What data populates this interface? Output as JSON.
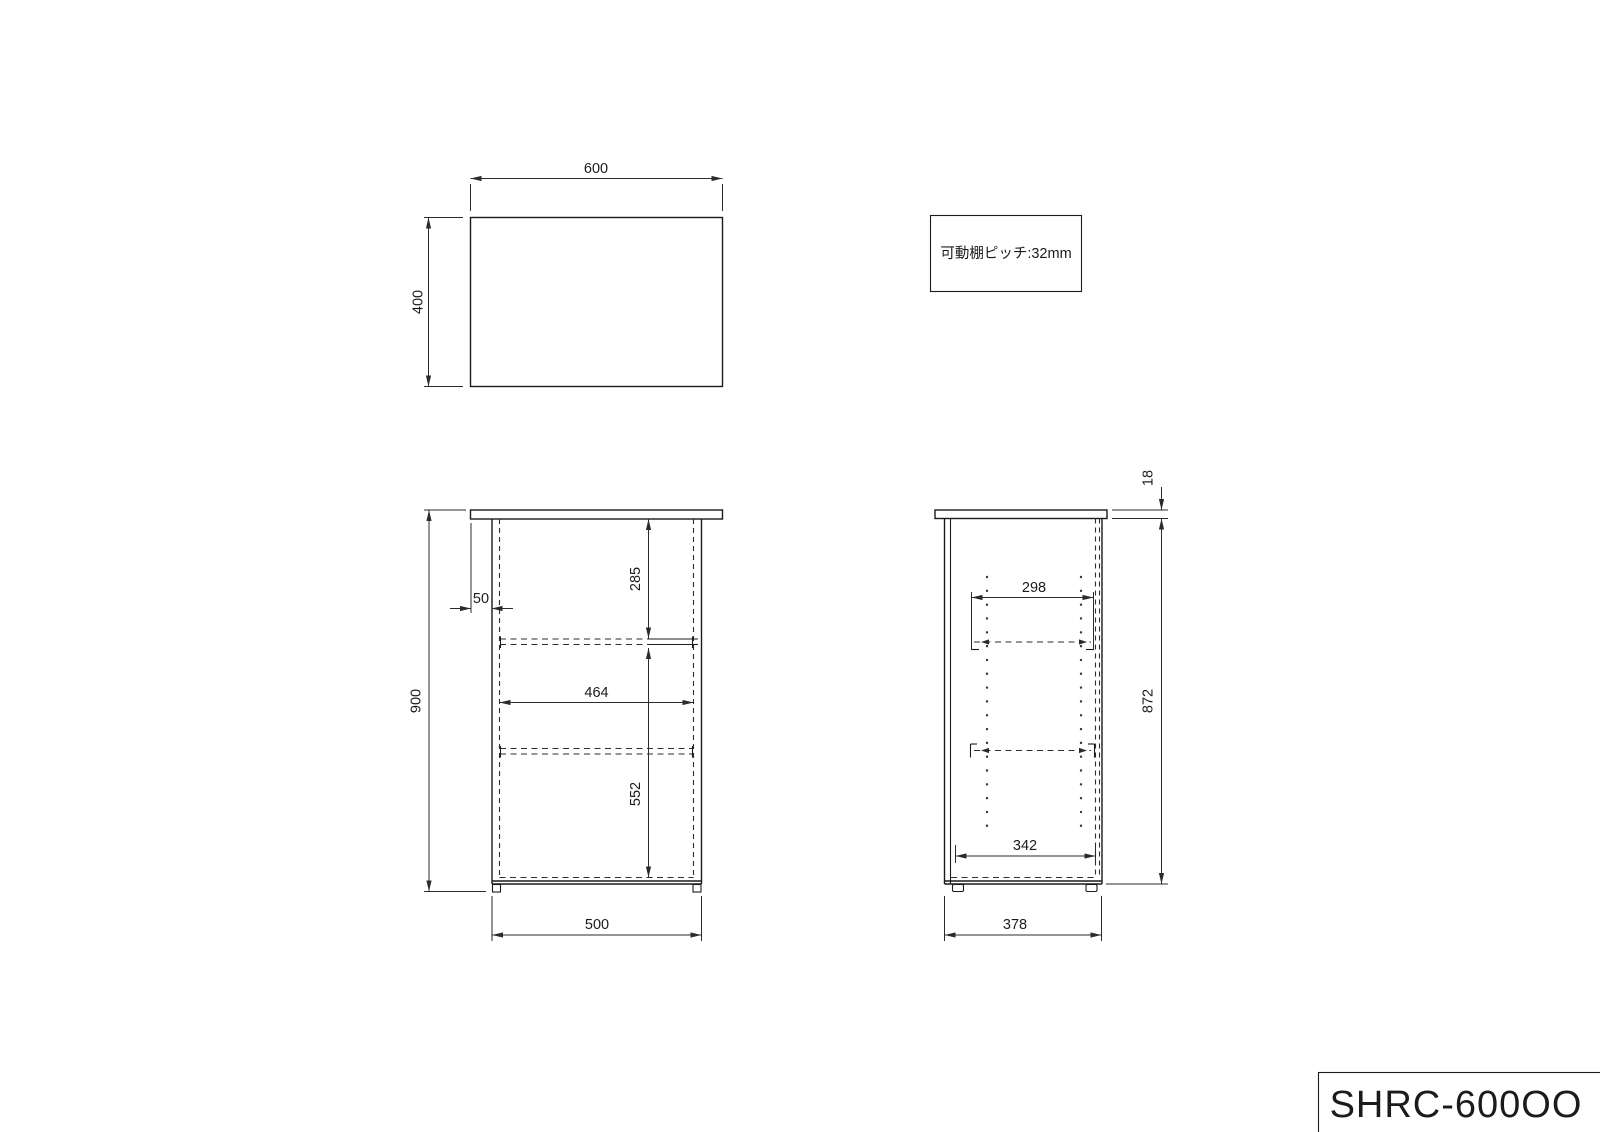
{
  "drawing": {
    "note": "可動棚棚ピッチ:32mm",
    "note_text": "可動棚ピッチ:32mm",
    "title": "SHRC-600OO",
    "top_view": {
      "width": "600",
      "depth": "400"
    },
    "front_view": {
      "overall_height": "900",
      "top_overhang": "50",
      "top_to_shelf": "285",
      "inner_width": "464",
      "shelf_to_bottom": "552",
      "body_width": "500"
    },
    "side_view": {
      "top_thickness": "18",
      "shelf_depth": "298",
      "body_height": "872",
      "inner_depth": "342",
      "body_depth": "378"
    }
  }
}
